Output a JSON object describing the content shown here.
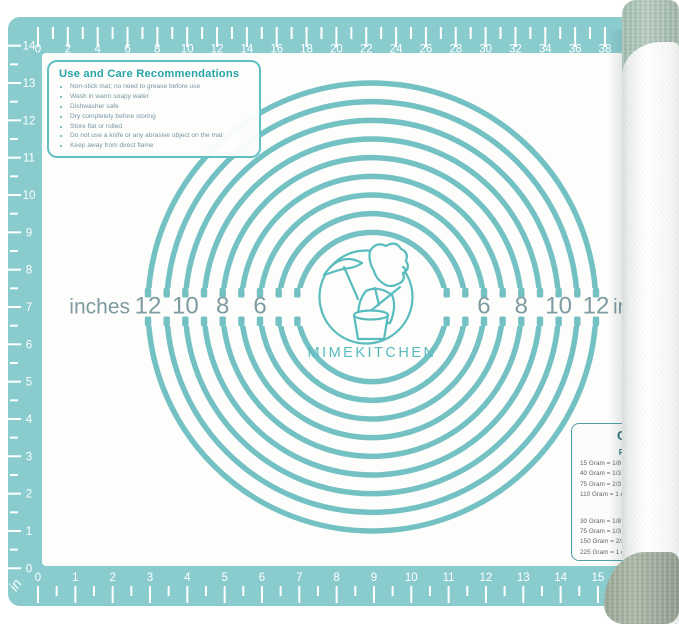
{
  "product": {
    "type": "pastry-baking-mat"
  },
  "colors": {
    "mat_teal": "#8accce",
    "field_white": "#fdfdfb",
    "circle_teal": "#74c1c4",
    "ruler_mark": "#ffffff",
    "scale_text": "#7e9ba1",
    "logo_teal": "#58bcbf",
    "care_title_teal": "#27a4a8",
    "care_text": "#7696a1",
    "cups_title_teal": "#2d6e79",
    "cups_text": "#5e6569",
    "roll_cap_top": "#abc3b5",
    "roll_cap_bottom": "#a0ad9e"
  },
  "logo": {
    "text": "MIMEKITCHEN"
  },
  "care_box": {
    "title": "Use and Care Recommendations",
    "items": [
      "Non-stick mat; no need to grease before use",
      "Wash in warm soapy water",
      "Dishwasher safe",
      "Dry completely before storing",
      "Store flat or rolled",
      "Do not use a knife or any abrasive object on the mat",
      "Keep away from direct flame"
    ]
  },
  "center_scale": {
    "unit_label": "inches",
    "ring_diameters_in": [
      4,
      5,
      6,
      7,
      8,
      9,
      10,
      11,
      12
    ],
    "ring_labels": [
      6,
      8,
      10,
      12
    ]
  },
  "rulers": {
    "top": {
      "labels": [
        "0",
        "2",
        "4",
        "6",
        "8",
        "10",
        "12",
        "14",
        "16",
        "18",
        "20",
        "22",
        "24",
        "26",
        "28",
        "30",
        "32",
        "34",
        "36",
        "38"
      ]
    },
    "left": {
      "labels": [
        "14",
        "13",
        "12",
        "11",
        "10",
        "9",
        "8",
        "7",
        "6",
        "5",
        "4",
        "3",
        "2",
        "1",
        "0"
      ],
      "unit_label": "in"
    },
    "bottom": {
      "labels": [
        "0",
        "1",
        "2",
        "3",
        "4",
        "5",
        "6",
        "7",
        "8",
        "9",
        "10",
        "11",
        "12",
        "13",
        "14",
        "15"
      ]
    }
  },
  "cups_chart": {
    "title": "CUPS",
    "sections": [
      {
        "heading": "Flour and",
        "rows": [
          "15 Gram = 1/8 cup",
          "40 Gram = 1/3 cup",
          "75 Gram = 2/3 cup",
          "110 Gram =  1 cup"
        ]
      },
      {
        "heading": "Butter",
        "rows": [
          "30 Gram = 1/8 cup",
          "75 Gram = 1/3 cup",
          "150 Gram = 2/3 cup",
          "225 Gram =  1 cup"
        ]
      }
    ]
  }
}
